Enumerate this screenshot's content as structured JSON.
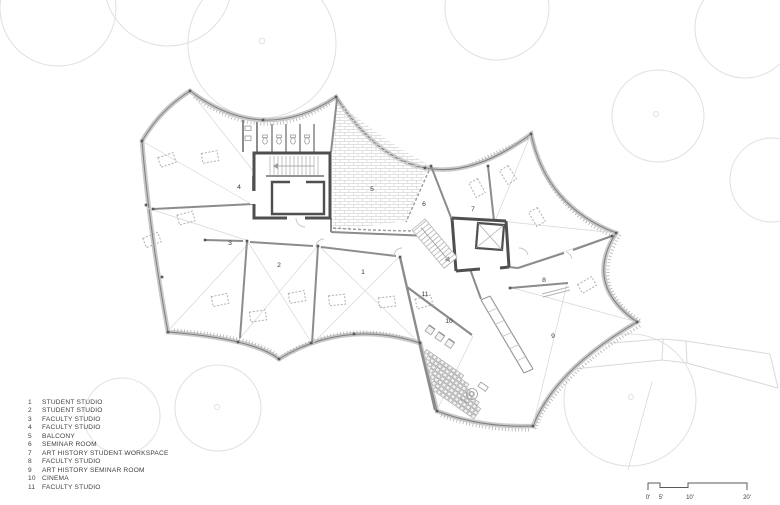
{
  "legend": {
    "items": [
      {
        "num": "1",
        "label": "STUDENT STUDIO"
      },
      {
        "num": "2",
        "label": "STUDENT STUDIO"
      },
      {
        "num": "3",
        "label": "FACULTY STUDIO"
      },
      {
        "num": "4",
        "label": "FACULTY STUDIO"
      },
      {
        "num": "5",
        "label": "BALCONY"
      },
      {
        "num": "6",
        "label": "SEMINAR ROOM"
      },
      {
        "num": "7",
        "label": "ART HISTORY STUDENT WORKSPACE"
      },
      {
        "num": "8",
        "label": "FACULTY STUDIO"
      },
      {
        "num": "9",
        "label": "ART HISTORY SEMINAR ROOM"
      },
      {
        "num": "10",
        "label": "CINEMA"
      },
      {
        "num": "11",
        "label": "FACULTY STUDIO"
      }
    ]
  },
  "rooms": [
    {
      "number": "1"
    },
    {
      "number": "2"
    },
    {
      "number": "3"
    },
    {
      "number": "4"
    },
    {
      "number": "5"
    },
    {
      "number": "6"
    },
    {
      "number": "7"
    },
    {
      "number": "8"
    },
    {
      "number": "9"
    },
    {
      "number": "10"
    },
    {
      "number": "11"
    }
  ],
  "scalebar": {
    "labels": [
      "0'",
      "5'",
      "10'",
      "20'"
    ]
  },
  "colors": {
    "wall_gray": "#8c8c8c",
    "core_dark": "#4f4f4f",
    "outline_fill": "#c9c9c9",
    "thin_line": "#d5d5d5",
    "tree_line": "#dedede",
    "text": "#3f3f3f"
  }
}
